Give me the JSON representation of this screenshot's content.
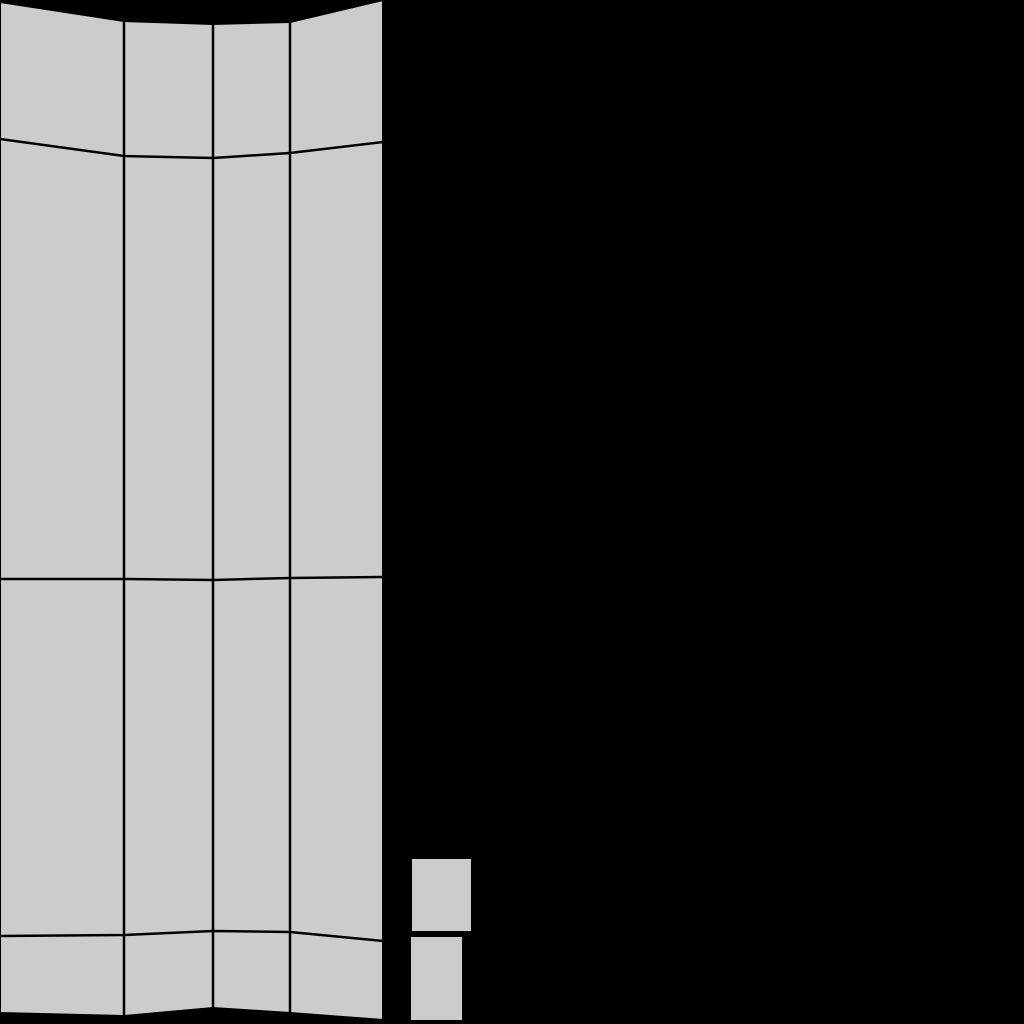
{
  "canvas": {
    "width": 1024,
    "height": 1024,
    "background_color": "#000000"
  },
  "mesh": {
    "face_color": "#cccccc",
    "edge_color": "#000000",
    "outline_width": 2,
    "edge_width": 2.5,
    "columns_x": [
      0,
      124,
      213,
      290,
      383
    ],
    "row_boundaries_y": [
      [
        2,
        21,
        24,
        22,
        0
      ],
      [
        139,
        156,
        158,
        153,
        142
      ],
      [
        579,
        579,
        580,
        578,
        577
      ],
      [
        936,
        935,
        931,
        932,
        941
      ],
      [
        1013,
        1016,
        1008,
        1013,
        1020
      ]
    ]
  },
  "detached_quads": [
    {
      "x": 411,
      "y": 858,
      "width": 61,
      "height": 74
    },
    {
      "x": 410,
      "y": 936,
      "width": 53,
      "height": 85
    }
  ]
}
